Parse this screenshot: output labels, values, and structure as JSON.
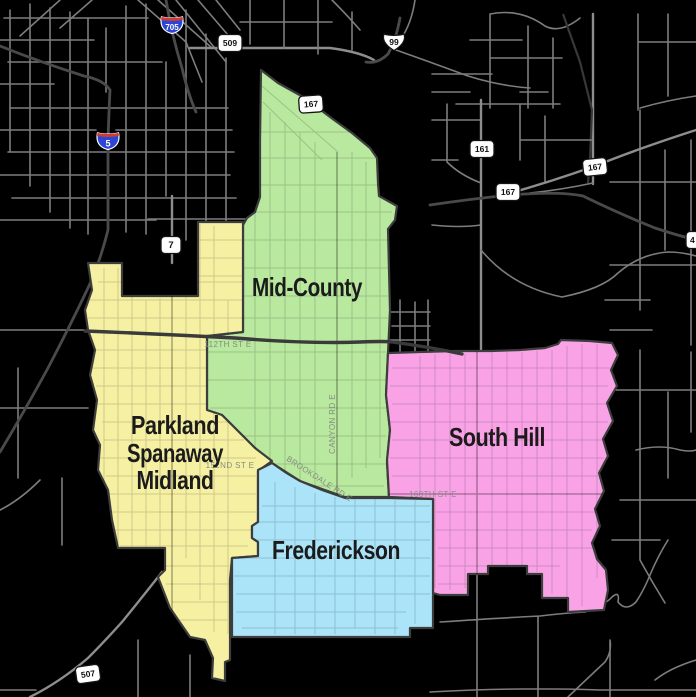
{
  "map": {
    "regions": [
      {
        "name": "Mid-County",
        "color": "#b9e89f"
      },
      {
        "name": "Parkland Spanaway Midland",
        "lines": [
          "Parkland",
          "Spanaway",
          "Midland"
        ],
        "color": "#f6f0a3"
      },
      {
        "name": "South Hill",
        "color": "#f9a3e6"
      },
      {
        "name": "Frederickson",
        "color": "#abe4f8"
      }
    ],
    "shields": [
      {
        "system": "interstate",
        "number": "705"
      },
      {
        "system": "interstate",
        "number": "5"
      },
      {
        "system": "us-route",
        "number": "99"
      },
      {
        "system": "state-route",
        "number": "509"
      },
      {
        "system": "state-route",
        "number": "167"
      },
      {
        "system": "state-route",
        "number": "161"
      },
      {
        "system": "state-route",
        "number": "167"
      },
      {
        "system": "state-route",
        "number": "167"
      },
      {
        "system": "state-route",
        "number": "7"
      },
      {
        "system": "state-route",
        "number": "507"
      },
      {
        "system": "state-route",
        "number": "4"
      }
    ],
    "road_labels": [
      {
        "text": "112TH ST E"
      },
      {
        "text": "CANYON RD E"
      },
      {
        "text": "BROOKDALE RD E"
      },
      {
        "text": "160TH ST E"
      },
      {
        "text": "152ND ST E"
      }
    ],
    "colors": {
      "background": "#000000",
      "road": "#7d7d7d",
      "freeway": "#3a3a3a",
      "region_border": "#3d3d3d",
      "interstate_blue": "#2b46d4",
      "interstate_red": "#d03a34",
      "shield_white": "#ffffff",
      "region_label": "#1b1b1b",
      "road_label": "#858c80"
    }
  }
}
